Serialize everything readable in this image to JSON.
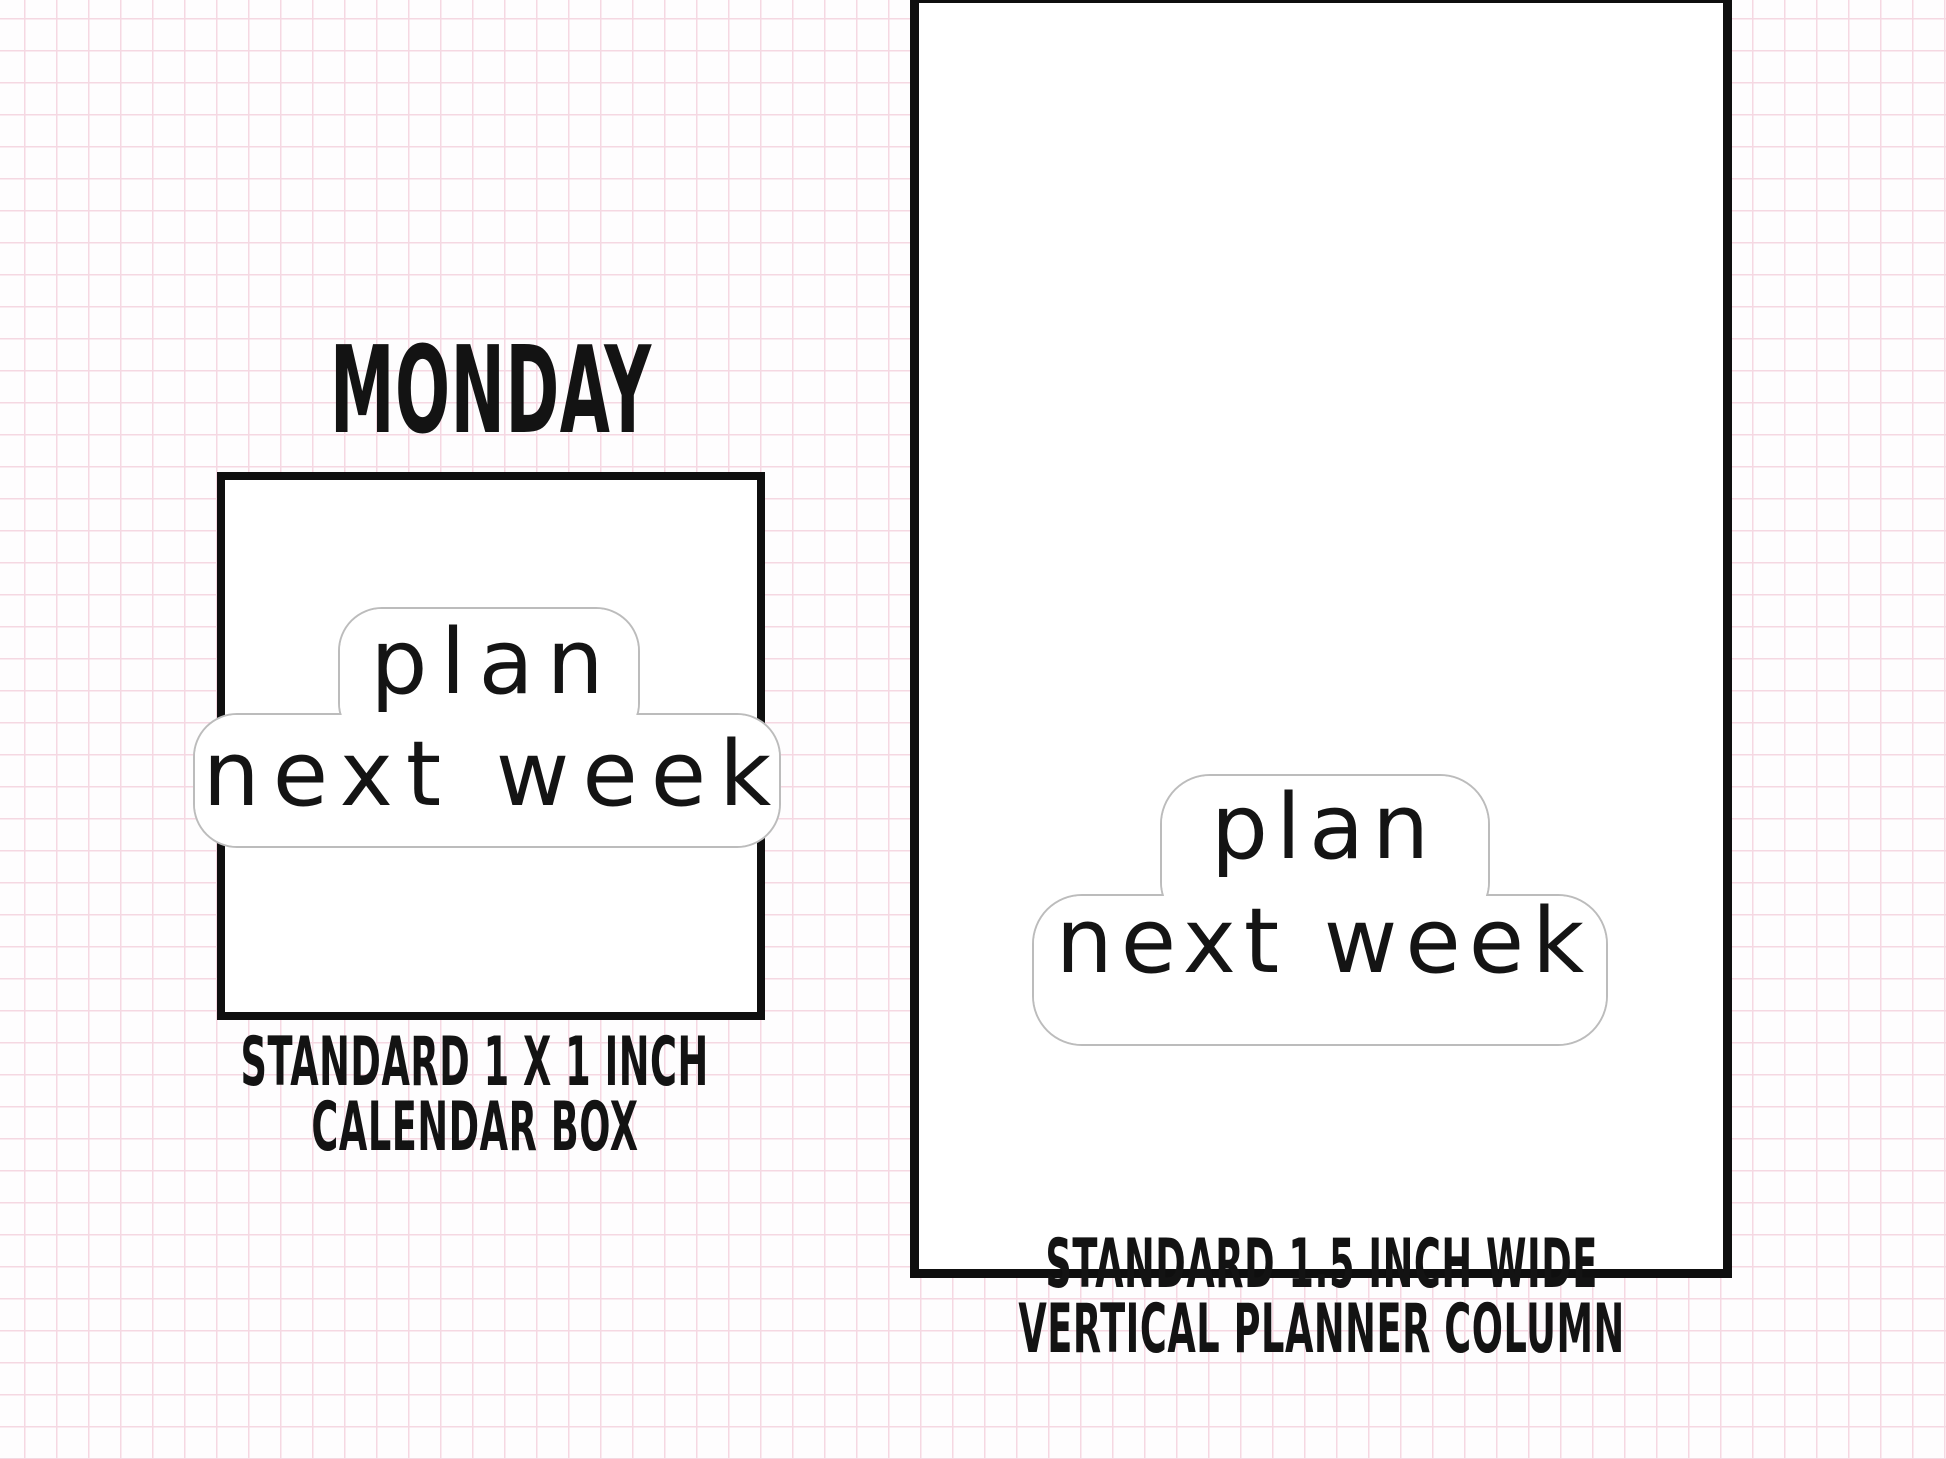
{
  "page": {
    "background_grid_color": "#f5d8e2",
    "box_border_color": "#0f0f0f",
    "sticker_outline_color": "#bcbcbc",
    "text_color": "#131313"
  },
  "left_panel": {
    "day_label": "MONDAY",
    "sticker": {
      "line1": "plan",
      "line2": "next week"
    },
    "caption_line1": "STANDARD 1 X 1 INCH",
    "caption_line2": "CALENDAR BOX"
  },
  "right_panel": {
    "sticker": {
      "line1": "plan",
      "line2": "next week"
    },
    "caption_line1": "STANDARD 1.5 INCH WIDE",
    "caption_line2": "VERTICAL PLANNER COLUMN"
  }
}
